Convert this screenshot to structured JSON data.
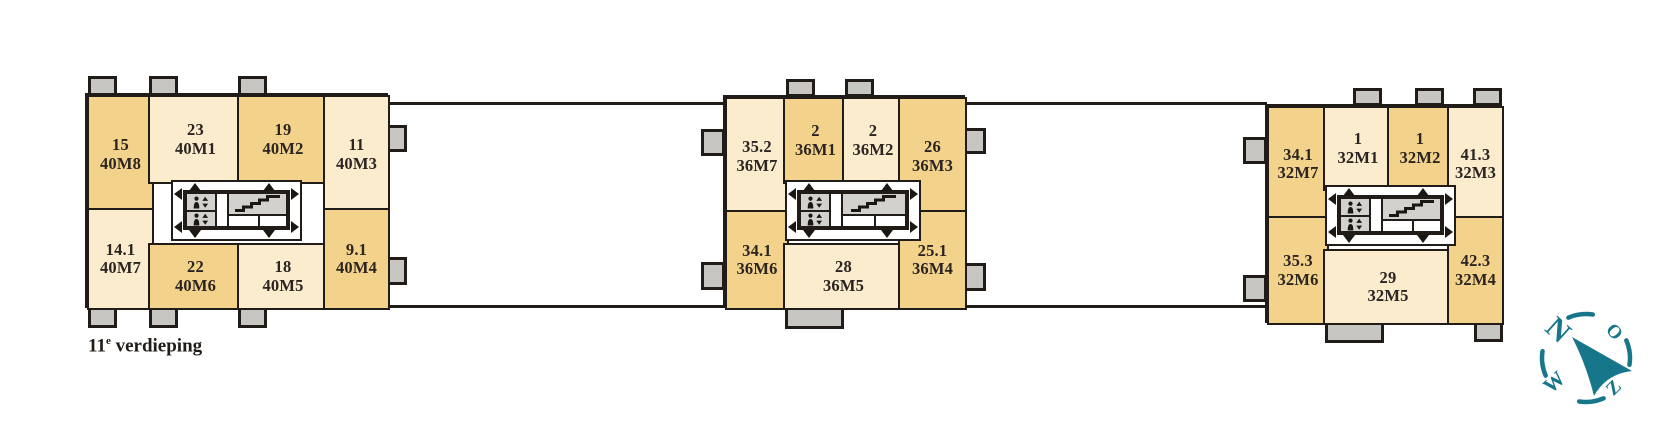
{
  "floor_label": {
    "number": "11",
    "ordinal": "e",
    "word": "verdieping"
  },
  "colors": {
    "unit_dark": "#f3d38c",
    "unit_light": "#faeccd",
    "wall": "#211c18",
    "balcony_gray": "#c7c6c3",
    "core_gray": "#d3d1ce",
    "compass_teal": "#17768a",
    "label_text": "#2b2420"
  },
  "core_icons": {
    "elevator": "elevator-icon",
    "stairs": "stairs-icon"
  },
  "blocks": [
    {
      "name": "block-40",
      "rooms": [
        {
          "number": "15",
          "code": "40M8",
          "shade": "dark"
        },
        {
          "number": "23",
          "code": "40M1",
          "shade": "light"
        },
        {
          "number": "19",
          "code": "40M2",
          "shade": "dark"
        },
        {
          "number": "11",
          "code": "40M3",
          "shade": "light"
        },
        {
          "number": "14.1",
          "code": "40M7",
          "shade": "light"
        },
        {
          "number": "22",
          "code": "40M6",
          "shade": "dark"
        },
        {
          "number": "18",
          "code": "40M5",
          "shade": "light"
        },
        {
          "number": "9.1",
          "code": "40M4",
          "shade": "dark"
        }
      ]
    },
    {
      "name": "block-36",
      "rooms": [
        {
          "number": "35.2",
          "code": "36M7",
          "shade": "light"
        },
        {
          "number": "2",
          "code": "36M1",
          "shade": "dark"
        },
        {
          "number": "2",
          "code": "36M2",
          "shade": "light"
        },
        {
          "number": "26",
          "code": "36M3",
          "shade": "dark"
        },
        {
          "number": "34.1",
          "code": "36M6",
          "shade": "dark"
        },
        {
          "number": "28",
          "code": "36M5",
          "shade": "light"
        },
        {
          "number": "25.1",
          "code": "36M4",
          "shade": "dark"
        }
      ]
    },
    {
      "name": "block-32",
      "rooms": [
        {
          "number": "34.1",
          "code": "32M7",
          "shade": "dark"
        },
        {
          "number": "1",
          "code": "32M1",
          "shade": "light"
        },
        {
          "number": "1",
          "code": "32M2",
          "shade": "dark"
        },
        {
          "number": "41.3",
          "code": "32M3",
          "shade": "light"
        },
        {
          "number": "35.3",
          "code": "32M6",
          "shade": "dark"
        },
        {
          "number": "29",
          "code": "32M5",
          "shade": "light"
        },
        {
          "number": "42.3",
          "code": "32M4",
          "shade": "dark"
        }
      ]
    }
  ],
  "compass": {
    "north": "N",
    "east": "O",
    "south": "Z",
    "west": "W"
  }
}
